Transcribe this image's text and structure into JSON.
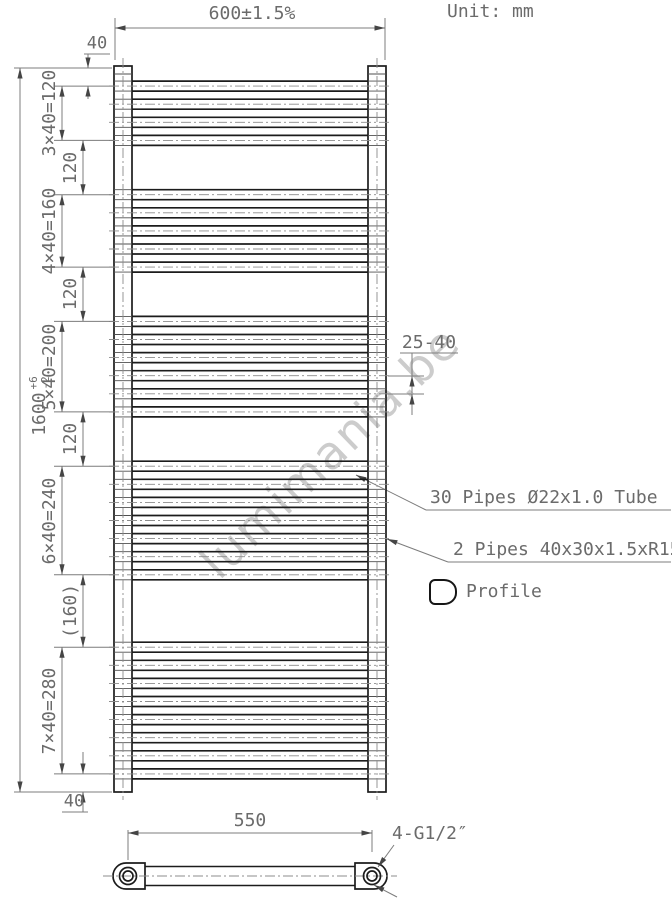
{
  "header": {
    "unit_label": "Unit: mm"
  },
  "watermark_text": "lumimania.be",
  "front_view": {
    "width_dim": "600±1.5%",
    "height_dim": "1600",
    "height_tol_plus": "+6",
    "height_tol_minus": "-2",
    "top_offset": "40",
    "bottom_offset": "40",
    "pitch_range": "25-40",
    "top_mm": 40,
    "pitch_mm": 40,
    "height_mm": 1600,
    "gaps_mm": [
      120,
      120,
      120,
      160
    ],
    "gap_labels": [
      "120",
      "120",
      "120",
      "(160)"
    ],
    "groups": [
      {
        "label": "3×40=120",
        "pipes": 4
      },
      {
        "label": "4×40=160",
        "pipes": 5
      },
      {
        "label": "5×40=200",
        "pipes": 6
      },
      {
        "label": "6×40=240",
        "pipes": 7
      },
      {
        "label": "7×40=280",
        "pipes": 8
      }
    ]
  },
  "annotations": {
    "pipes_note": "30 Pipes Ø22x1.0 Tube",
    "side_tubes_note": "2 Pipes 40x30x1.5xR15",
    "profile_label": "Profile"
  },
  "bottom_view": {
    "center_distance": "550",
    "connection_label": "4-G1/2″"
  }
}
